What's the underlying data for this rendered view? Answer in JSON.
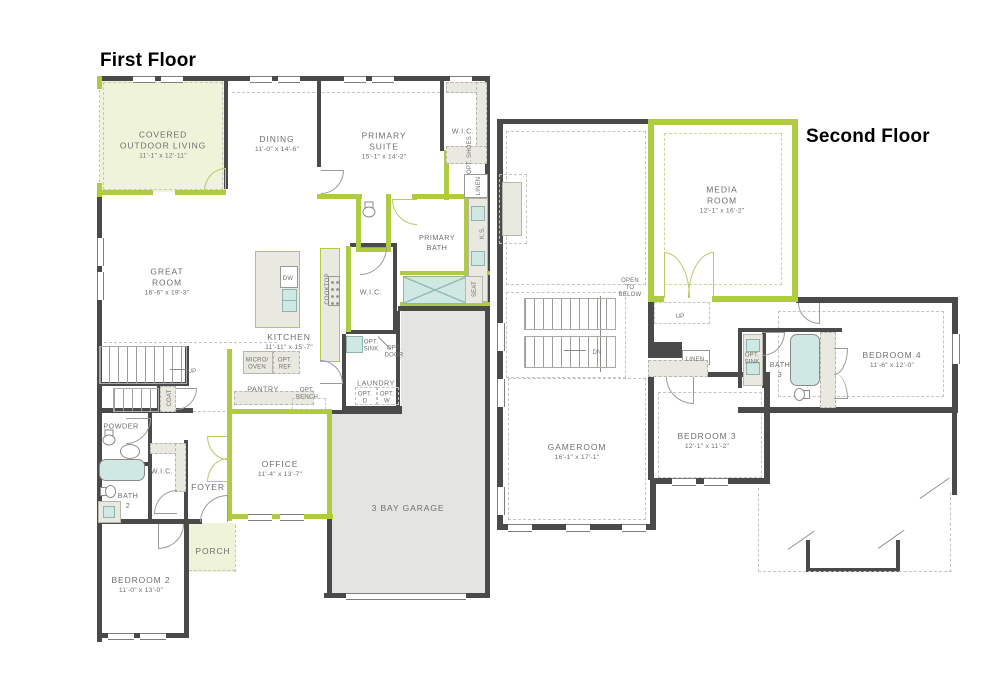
{
  "colors": {
    "wall": "#4a4a4a",
    "green": "#aecb43",
    "green_fill": "#eef3da",
    "garage_fill": "#e4e4e3",
    "fixture": "#cfe8e4",
    "counter": "#eae9e1",
    "label": "#6f6f6e",
    "dash": "#c6c6bf",
    "title": "#000000"
  },
  "floors": {
    "first": {
      "title": "First Floor",
      "labels": {
        "covered_outdoor": {
          "name": "COVERED\nOUTDOOR LIVING",
          "dims": "11'-1\" x 12'-11\""
        },
        "dining": {
          "name": "DINING",
          "dims": "11'-0\" x 14'-6\""
        },
        "primary_suite": {
          "name": "PRIMARY\nSUITE",
          "dims": "15'-1\" x 14'-2\""
        },
        "wic_primary": {
          "name": "W.I.C."
        },
        "opt_shoes": {
          "name": "OPT. SHOES"
        },
        "linen": {
          "name": "LINEN"
        },
        "ks": {
          "name": "K.S."
        },
        "seat": {
          "name": "SEAT"
        },
        "primary_bath": {
          "name": "PRIMARY\nBATH"
        },
        "wic_bath": {
          "name": "W.I.C."
        },
        "great_room": {
          "name": "GREAT\nROOM",
          "dims": "16'-6\" x 19'-3\""
        },
        "kitchen": {
          "name": "KITCHEN",
          "dims": "11'-11\" x 15'-7\""
        },
        "dw": {
          "name": "DW"
        },
        "cooktop": {
          "name": "COOKTOP"
        },
        "micro_oven": {
          "name": "MICRO/\nOVEN"
        },
        "opt_ref": {
          "name": "OPT.\nREF"
        },
        "pantry": {
          "name": "PANTRY"
        },
        "opt_bench": {
          "name": "OPT.\nBENCH"
        },
        "opt_sink": {
          "name": "OPT.\nSINK"
        },
        "opt_door": {
          "name": "OPT.\nDOOR"
        },
        "laundry": {
          "name": "LAUNDRY"
        },
        "opt_d": {
          "name": "OPT.\nD"
        },
        "opt_w": {
          "name": "OPT.\nW"
        },
        "up": {
          "name": "UP"
        },
        "coat": {
          "name": "COAT"
        },
        "powder": {
          "name": "POWDER"
        },
        "wic_foyer": {
          "name": "W.I.C."
        },
        "bath2": {
          "name": "BATH\n2"
        },
        "foyer": {
          "name": "FOYER"
        },
        "office": {
          "name": "OFFICE",
          "dims": "11'-4\" x 13'-7\""
        },
        "porch": {
          "name": "PORCH"
        },
        "bedroom2": {
          "name": "BEDROOM 2",
          "dims": "11'-0\" x 13'-0\""
        },
        "garage": {
          "name": "3 BAY GARAGE"
        }
      }
    },
    "second": {
      "title": "Second Floor",
      "labels": {
        "media_room": {
          "name": "MEDIA\nROOM",
          "dims": "12'-1\" x 16'-2\""
        },
        "open_below": {
          "name": "OPEN\nTO\nBELOW"
        },
        "up": {
          "name": "UP"
        },
        "dn": {
          "name": "DN"
        },
        "gameroom": {
          "name": "GAMEROOM",
          "dims": "16'-1\" x 17'-1\""
        },
        "bedroom3": {
          "name": "BEDROOM 3",
          "dims": "12'-1\" x 11'-2\""
        },
        "linen": {
          "name": "LINEN"
        },
        "opt_sink": {
          "name": "OPT.\nSINK"
        },
        "bath3": {
          "name": "BATH\n3"
        },
        "bedroom4": {
          "name": "BEDROOM 4",
          "dims": "11'-6\" x 12'-0\""
        }
      }
    }
  }
}
